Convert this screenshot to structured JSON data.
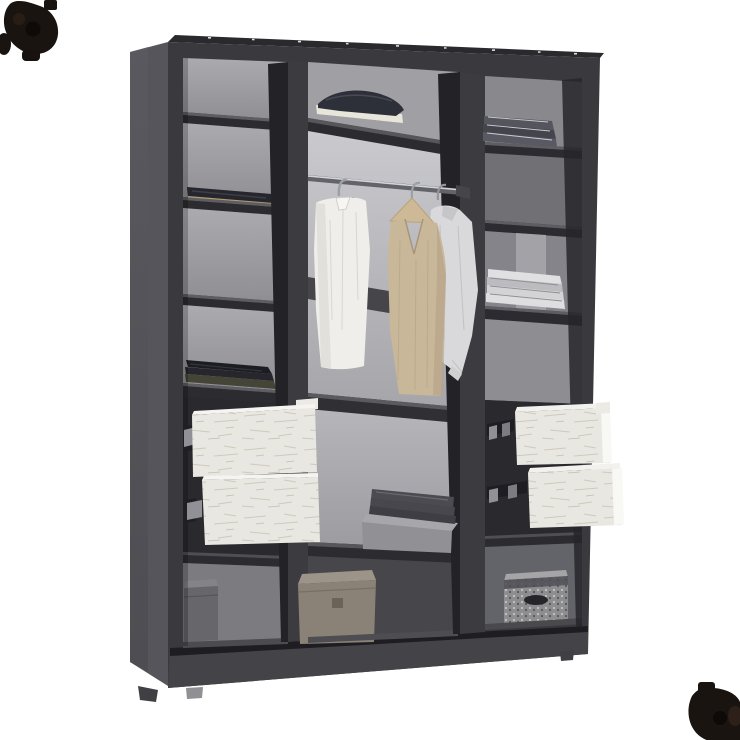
{
  "canvas": {
    "width": 740,
    "height": 740
  },
  "scene_label": "open-three-section-wardrobe-product-render",
  "colors": {
    "background": "#ffffff",
    "frame": "#3a3a3e",
    "frame_top": "#2a2a2e",
    "side_panel": "#55555b",
    "plinth": "#434348",
    "divider": "#3c3c40",
    "divider_side": "#232327",
    "shelf_top": "#5d5d62",
    "shelf_front": "#2c2c30",
    "back_left": "#a2a2a6",
    "back_middle": "#c0c0c4",
    "back_right": "#85858a",
    "cavity": "#2a2a2e",
    "drawer_face": "#e9e7e1",
    "drawer_edge": "#f5f4f0",
    "rail_metal": "#909096",
    "rod": "#63636a",
    "rod_highlight": "#d5d5d9",
    "shirt_white": "#efeeeb",
    "dress_beige": "#c9b79a",
    "shirt_gray": "#d9d9db",
    "hanger_wood": "#cdb995",
    "folded_navy": "#2e3039",
    "folded_cream": "#e8e5db",
    "folded_jeans": "#26272e",
    "jeans_trim": "#b09a72",
    "knit_black": "#1c1d22",
    "knit_olive": "#454537",
    "stack_gray": "#54555d",
    "stack_white": "#dedee0",
    "towel_gray": "#4b4b51",
    "box_gray": "#909095",
    "box_taupe": "#8b8277",
    "box_small": "#66666b",
    "basket": "#8e8e91",
    "basket_hole": "#26262a",
    "watermark": "#1a1411"
  },
  "inventory": {
    "left_column": [
      "folded-jeans",
      "folded-black-knitwear",
      "white-drawer",
      "white-drawer",
      "small-gray-box"
    ],
    "middle_column": [
      "folded-navy-and-cream-stack",
      "clothes-rail",
      "white-shirt-on-hanger",
      "beige-dress-on-wooden-hanger",
      "gray-shirt-on-hanger",
      "gray-towels-on-box",
      "taupe-storage-box"
    ],
    "right_column": [
      "folded-gray-garments",
      "folded-white-linens",
      "white-drawer",
      "white-drawer",
      "knit-basket"
    ]
  }
}
